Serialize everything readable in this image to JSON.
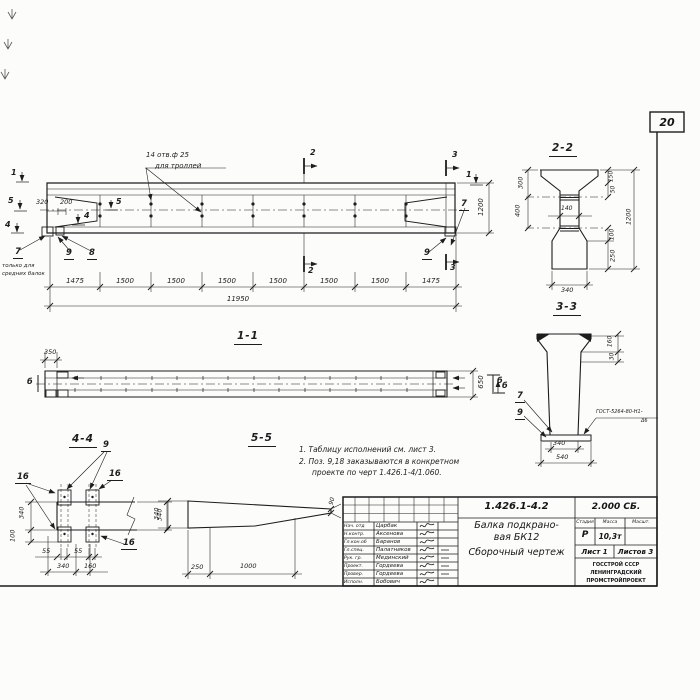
{
  "sheet": {
    "page_number": "20"
  },
  "colors": {
    "ink": "#1d1d1d",
    "paper": "#fcfcfa"
  },
  "marks": {
    "cut1": "1",
    "cut2": "2",
    "cut3": "3",
    "cut4": "4",
    "cut5": "5",
    "b": "б",
    "pos7": "7",
    "pos8": "8",
    "pos9": "9",
    "pos16": "16"
  },
  "main_view": {
    "holes_note_line1": "14 отв.ф 25",
    "holes_note_line2": "для троллей",
    "note_only_line1": "только для",
    "note_only_line2": "средних балок",
    "dim_320": "320",
    "dim_200": "200",
    "dim_1200": "1200",
    "chain": [
      "1475",
      "1500",
      "1500",
      "1500",
      "1500",
      "1500",
      "1500",
      "1475"
    ],
    "dim_total": "11950"
  },
  "view_1_1": {
    "label": "1-1",
    "dim_350": "350",
    "dim_650": "650"
  },
  "section_2_2": {
    "label": "2-2",
    "dim_300": "300",
    "dim_400": "400",
    "dim_140": "140",
    "dim_150": "150",
    "dim_50": "50",
    "dim_1200": "1200",
    "dim_100": "100",
    "dim_250": "250",
    "dim_340": "340"
  },
  "section_3_3": {
    "label": "3-3",
    "dim_160": "160",
    "dim_30": "30",
    "dim_340": "340",
    "dim_540": "540",
    "weld_note_line1": "ГОСТ-5264-80-Н1-",
    "weld_note_line2": "Δ6"
  },
  "view_4_4": {
    "label": "4-4",
    "dim_340_left": "340",
    "dim_100": "100",
    "dim_340_right": "340",
    "dim_55_a": "55",
    "dim_55_b": "55",
    "dim_340_bottom": "340",
    "dim_160": "160"
  },
  "view_5_5": {
    "label": "5-5",
    "dim_340": "340",
    "dim_250": "250",
    "dim_1000": "1000",
    "dim_90": "90"
  },
  "notes": {
    "line1": "1. Таблицу исполнений см. лист 3.",
    "line2": "2. Поз. 9,18 заказываются в конкретном",
    "line3": "проекте по черт 1.426.1-4/1.060."
  },
  "title_block": {
    "doc_code": "1.426.1-4.2",
    "doc_series": "2.000 СБ.",
    "title_line1": "Балка подкрано-",
    "title_line2": "вая БК12",
    "title_line3": "Сборочный чертеж",
    "col_stage": "Стадия",
    "col_mass": "Масса",
    "col_scale": "Масшт.",
    "stage": "Р",
    "mass": "10,3т",
    "sheet_info": "Лист 1",
    "sheets_info": "Листов 3",
    "org_line1": "ГОССТРОЙ СССР",
    "org_line2": "ЛЕНИНГРАДСКИЙ",
    "org_line3": "ПРОМСТРОЙПРОЕКТ",
    "staff": [
      {
        "role": "Нач. отд",
        "name": "Царбак"
      },
      {
        "role": "Н.контр.",
        "name": "Аксенова"
      },
      {
        "role": "Гл.кон.об",
        "name": "Баранов"
      },
      {
        "role": "Гл.спец.",
        "name": "Палатников"
      },
      {
        "role": "Рук. гр.",
        "name": "Мединский"
      },
      {
        "role": "Проект.",
        "name": "Гордеева"
      },
      {
        "role": "Провер.",
        "name": "Гордеева"
      },
      {
        "role": "Исполн.",
        "name": "Бобович"
      }
    ]
  }
}
